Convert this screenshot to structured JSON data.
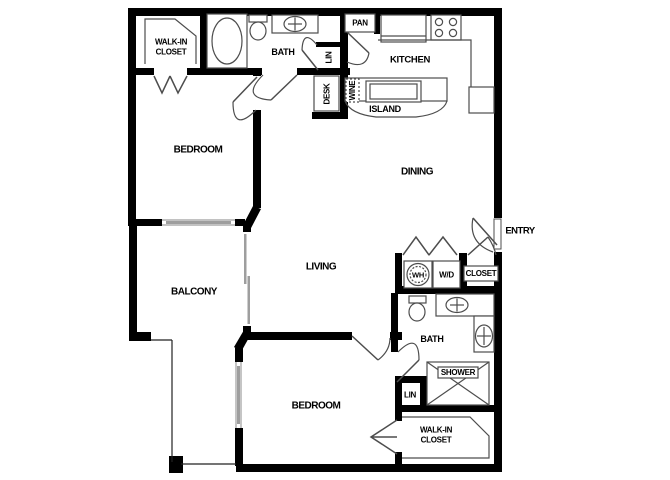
{
  "plan_type": "apartment-floor-plan",
  "colors": {
    "wall": "#000000",
    "fixture_line": "#4d4d4d",
    "window": "#9e9e9e",
    "background": "#ffffff",
    "text": "#000000"
  },
  "labels": {
    "walkin1_line1": "WALK-IN",
    "walkin1_line2": "CLOSET",
    "bath1": "BATH",
    "pan": "PAN",
    "kitchen": "KITCHEN",
    "lin1": "LIN",
    "desk": "DESK",
    "wine": "WINE",
    "island": "ISLAND",
    "bedroom1": "BEDROOM",
    "dining": "DINING",
    "balcony": "BALCONY",
    "living": "LIVING",
    "entry": "ENTRY",
    "wh": "WH",
    "wd": "W/D",
    "closet": "CLOSET",
    "bath2": "BATH",
    "shower": "SHOWER",
    "lin2": "LIN",
    "bedroom2": "BEDROOM",
    "walkin2_line1": "WALK-IN",
    "walkin2_line2": "CLOSET"
  }
}
